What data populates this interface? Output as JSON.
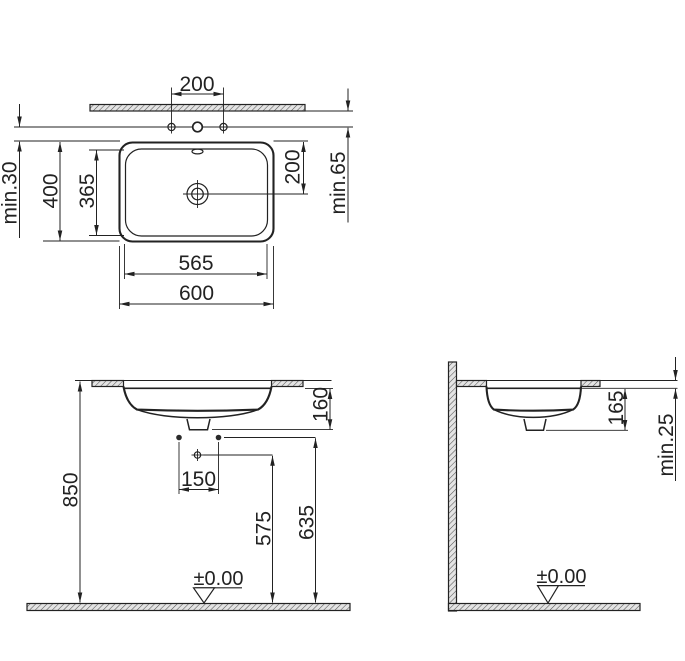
{
  "drawing": {
    "plan_view": {
      "tap_hole_spacing": "200",
      "rim_to_drain": "200",
      "min_wall_to_tap": "min.65",
      "min_tap_to_rim": "min.30",
      "outer_depth": "400",
      "inner_depth": "365",
      "inner_width": "565",
      "outer_width": "600"
    },
    "front_view": {
      "rim_to_drain_depth": "160",
      "supply_spacing": "150",
      "rim_height": "850",
      "waste_outlet_height": "575",
      "supply_height": "635",
      "datum_level": "±0.00"
    },
    "side_view": {
      "rim_to_drain_depth": "165",
      "min_counter_thickness": "min.25",
      "datum_level": "±0.00"
    },
    "colors": {
      "line": "#222222",
      "hatch_fill": "#e4e4e4",
      "hatch_stroke": "#555555",
      "background": "#ffffff"
    }
  }
}
